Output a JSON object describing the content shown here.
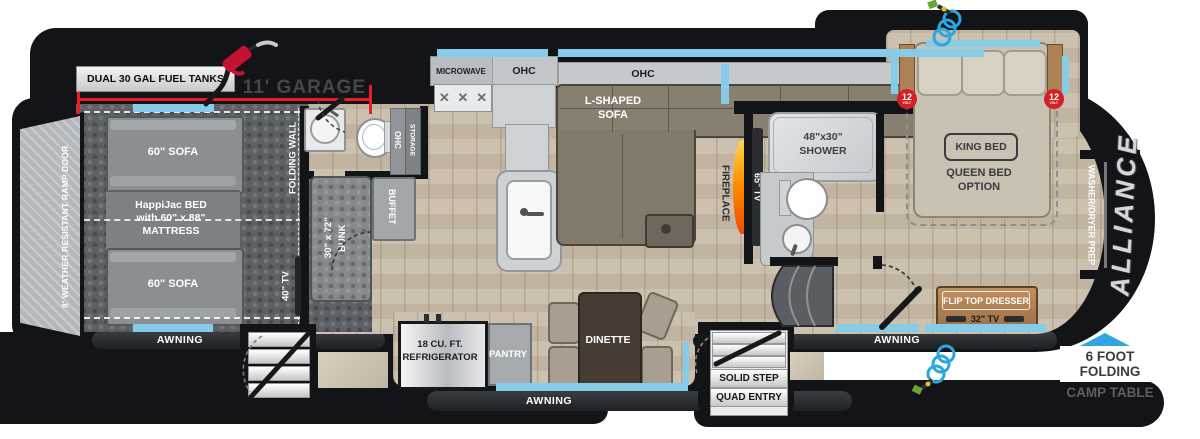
{
  "colors": {
    "body_black": "#131417",
    "slide_topper_blue": "#86cbe7",
    "awning_arrow_blue": "#31a5e0",
    "dimension_red": "#ed1c24",
    "volt_badge_red": "#d41f27",
    "flame_orange": "#ff8a00",
    "wood_floor": "#c9bda9",
    "garage_floor": "#5d6065",
    "brand_silver": "#d6d6da"
  },
  "exterior": {
    "fuel_tanks_label": "DUAL 30 GAL FUEL TANKS",
    "garage_dimension": "11' GARAGE",
    "ramp_door_label": "8' WEATHER RESISTANT RAMP DOOR",
    "awning_rear": "AWNING",
    "awning_main": "AWNING",
    "awning_front": "AWNING",
    "entry_step_line1": "SOLID STEP",
    "entry_step_line2": "QUAD ENTRY",
    "camp_table_line1": "6 FOOT",
    "camp_table_line2": "FOLDING",
    "camp_table_line3": "CAMP TABLE",
    "brand_name": "ALLIANCE",
    "volt_badge": "12",
    "volt_badge_sub": "VOLT"
  },
  "garage": {
    "sofa_front": "60\" SOFA",
    "sofa_rear": "60\" SOFA",
    "happijac_line1": "HappiJac BED",
    "happijac_line2": "with 60\" x 88\"",
    "happijac_line3": "MATTRESS",
    "folding_wall_label": "FOLDING WALL",
    "tv_label": "40\" TV"
  },
  "hallway": {
    "bunk_line1": "30\" x 72\"",
    "bunk_line2": "BUNK",
    "buffet_label": "BUFFET",
    "ohc_label": "OHC",
    "storage_label": "STORAGE"
  },
  "kitchen": {
    "microwave_label": "MICROWAVE",
    "ohc_label": "OHC",
    "fridge_line1": "18 CU. FT.",
    "fridge_line2": "REFRIGERATOR",
    "pantry_label": "PANTRY",
    "dinette_label": "DINETTE"
  },
  "living": {
    "ohc_label": "OHC",
    "sofa_line1": "L-SHAPED",
    "sofa_line2": "SOFA",
    "fireplace_label": "FIREPLACE",
    "tv_label": "65\" TV"
  },
  "bathroom": {
    "shower_line1": "48\"x30\"",
    "shower_line2": "SHOWER"
  },
  "bedroom": {
    "king_bed_label": "KING BED",
    "queen_line1": "QUEEN BED",
    "queen_line2": "OPTION",
    "dresser_label": "FLIP TOP DRESSER",
    "tv_label": "32\" TV",
    "washer_dryer_label": "WASHER/DRYER PREP"
  }
}
